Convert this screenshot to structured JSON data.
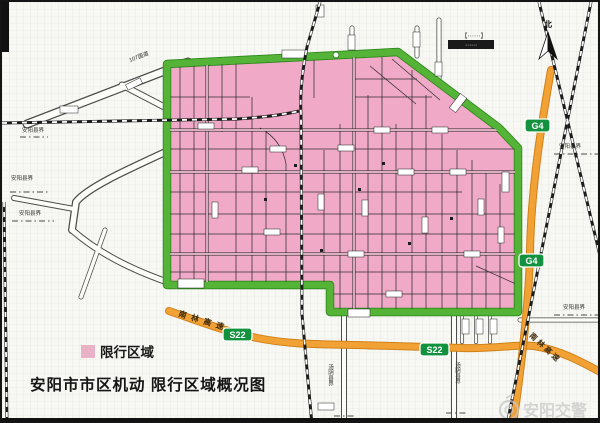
{
  "map": {
    "title": "安阳市市区机动 限行区域概况图",
    "legend": {
      "label": "限行区域",
      "swatch_color": "#e9b2c7"
    },
    "compass": {
      "label": "北"
    },
    "watermark": {
      "text": "安阳交警"
    },
    "badges": {
      "g4": "G4",
      "s22": "S22"
    },
    "road_names": {
      "nanlin_expressway": "南林高速",
      "g107": "107国道"
    },
    "boundary_labels": {
      "anyang_county": "安阳县界",
      "tangyin_county": "汤阴县界"
    },
    "micro": {
      "dots": "⋯⋯",
      "bracket": "【⋯⋯】",
      "dark": "⋯⋯"
    },
    "colors": {
      "restricted_zone_pink": "#f0a9c6",
      "zone_boundary_green": "#4fae33",
      "expressway_orange": "#f2a235",
      "badge_green": "#12923e",
      "railway_black": "#1c1c1c"
    }
  }
}
